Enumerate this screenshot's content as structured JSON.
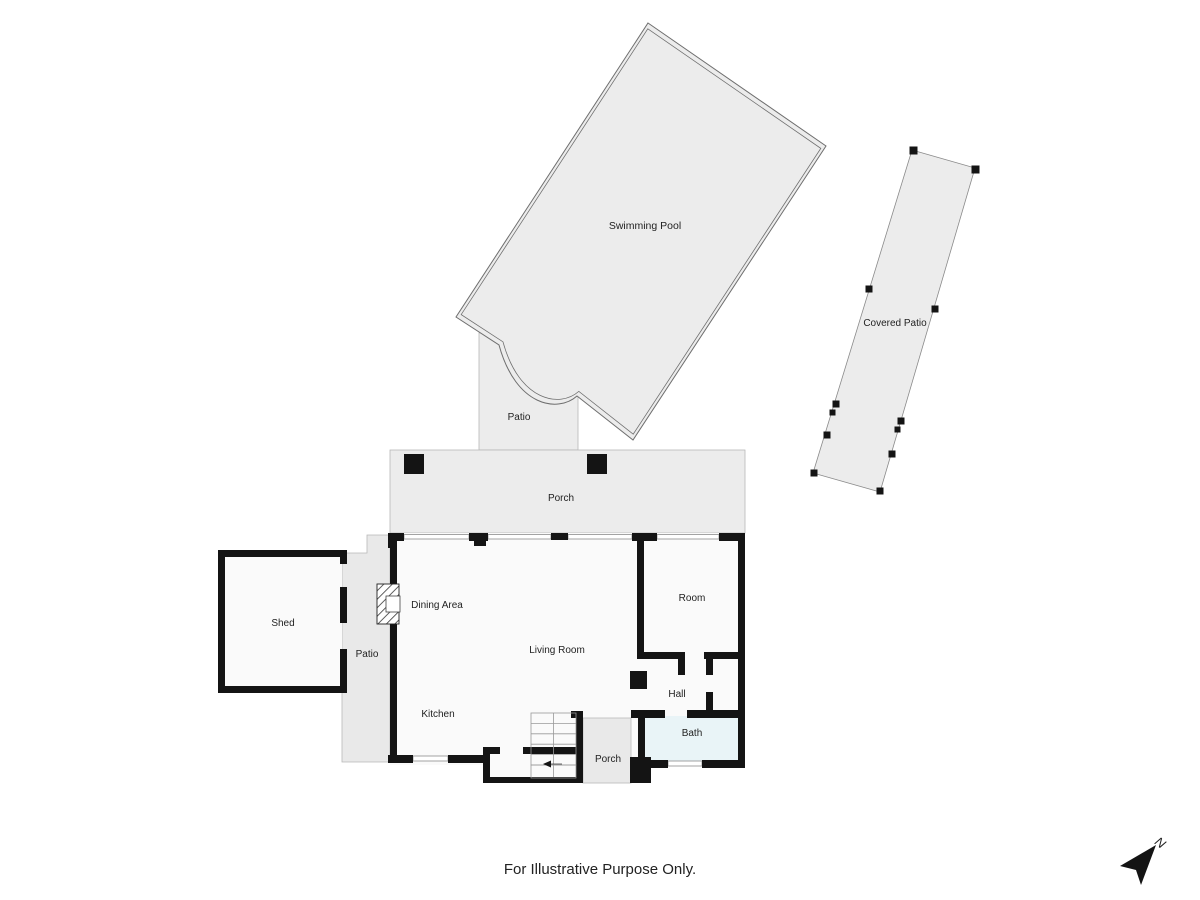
{
  "disclaimer": "For Illustrative Purpose Only.",
  "compass": {
    "label": "N"
  },
  "areas": {
    "swimming_pool": "Swimming Pool",
    "covered_patio": "Covered Patio",
    "pool_patio": "Patio",
    "porch_top": "Porch",
    "shed": "Shed",
    "side_patio": "Patio",
    "dining_area": "Dining Area",
    "living_room": "Living Room",
    "kitchen": "Kitchen",
    "room": "Room",
    "hall": "Hall",
    "bath": "Bath",
    "porch_bottom": "Porch"
  },
  "colors": {
    "wall": "#141414",
    "area_gray": "#ececec",
    "patio_gray": "#e9e9e9",
    "house_fill": "#fafafa",
    "bath_fill": "#e9f4f7",
    "outline": "#6e6e6e",
    "thin": "#b8b8b8",
    "stair": "#999999",
    "text": "#222222",
    "bg": "#ffffff"
  }
}
